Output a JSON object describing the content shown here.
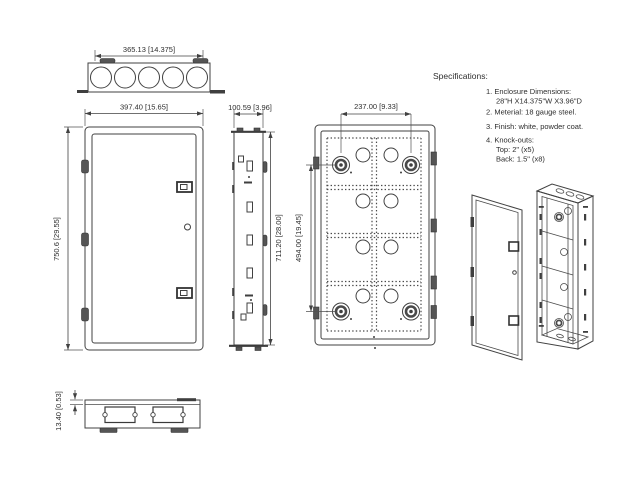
{
  "colors": {
    "line": "#414141",
    "background": "#ffffff",
    "text": "#2e2e2e"
  },
  "dims": {
    "top_width": "365.13 [14.375]",
    "front_width": "397.40 [15.65]",
    "front_height": "750.6 [29.55]",
    "side_width": "100.59 [3.96]",
    "side_height": "711.20 [28.00]",
    "back_knockout_width": "237.00 [9.33]",
    "back_knockout_height": "494.00 [19.45]",
    "bottom_lip": "13.40 [0.53]"
  },
  "specs": {
    "title": "Specifications:",
    "item1": "1. Enclosure Dimensions:",
    "item1b": "28\"H X14.375\"W X3.96\"D",
    "item2": "2. Meterial: 18 gauge steel.",
    "item3": "3. Finish: white, powder coat.",
    "item4": "4. Knock-outs:",
    "item4b": "Top: 2\" (x5)",
    "item4c": "Back: 1.5\" (x8)"
  }
}
